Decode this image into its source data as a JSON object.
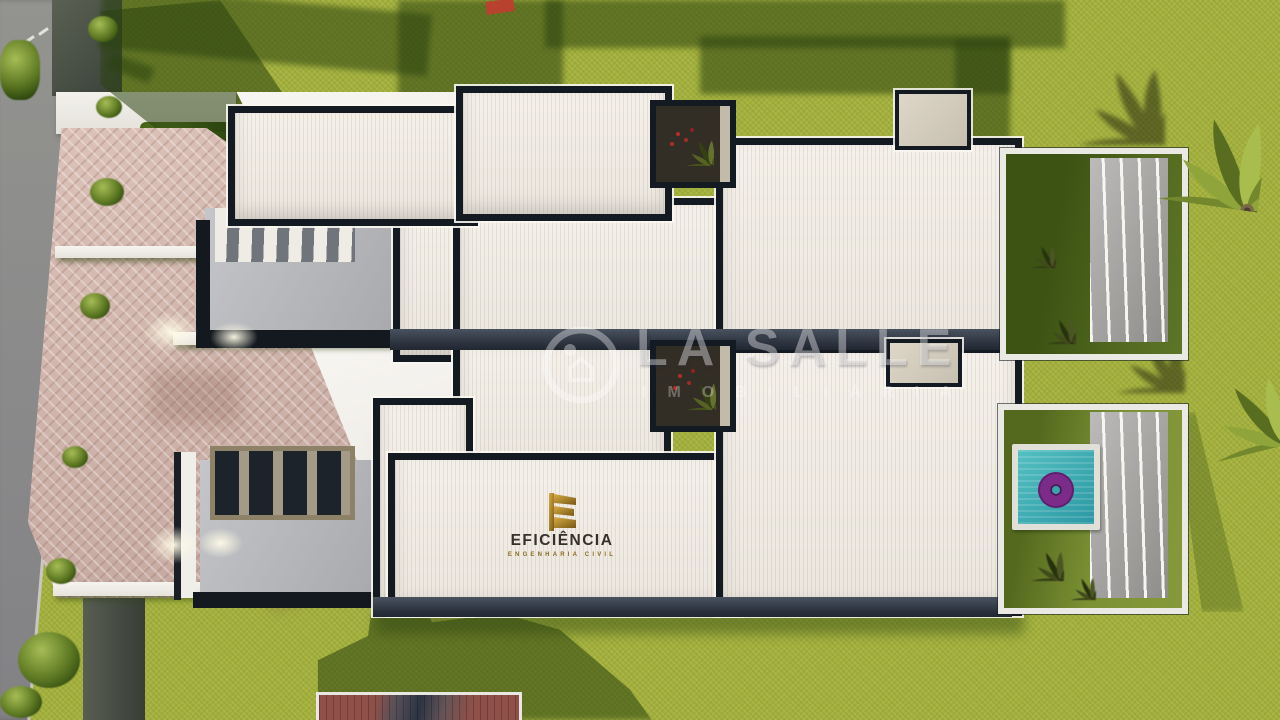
{
  "watermark": {
    "brand": "LA SALLE",
    "subtitle": "IMOBILIÁRIA",
    "icon": "realty-ring-badge-icon"
  },
  "builder": {
    "name": "EFICIÊNCIA",
    "tagline": "ENGENHARIA CIVIL",
    "icon": "gold-e-bars-icon"
  },
  "palette": {
    "lawn": "#a4b13d",
    "lawn_shadow": "#3f5c16",
    "roof_white": "#f2eee7",
    "parapet_dark": "#141a22",
    "paver_pink": "#cfb3aa",
    "road_gray": "#8d8d89",
    "concrete_gray": "#b7b8bc",
    "pool_teal": "#37a9ae",
    "float_purple": "#7c2b88",
    "logo_gold": "#a8832c",
    "pergola_tan": "#8d8268"
  }
}
